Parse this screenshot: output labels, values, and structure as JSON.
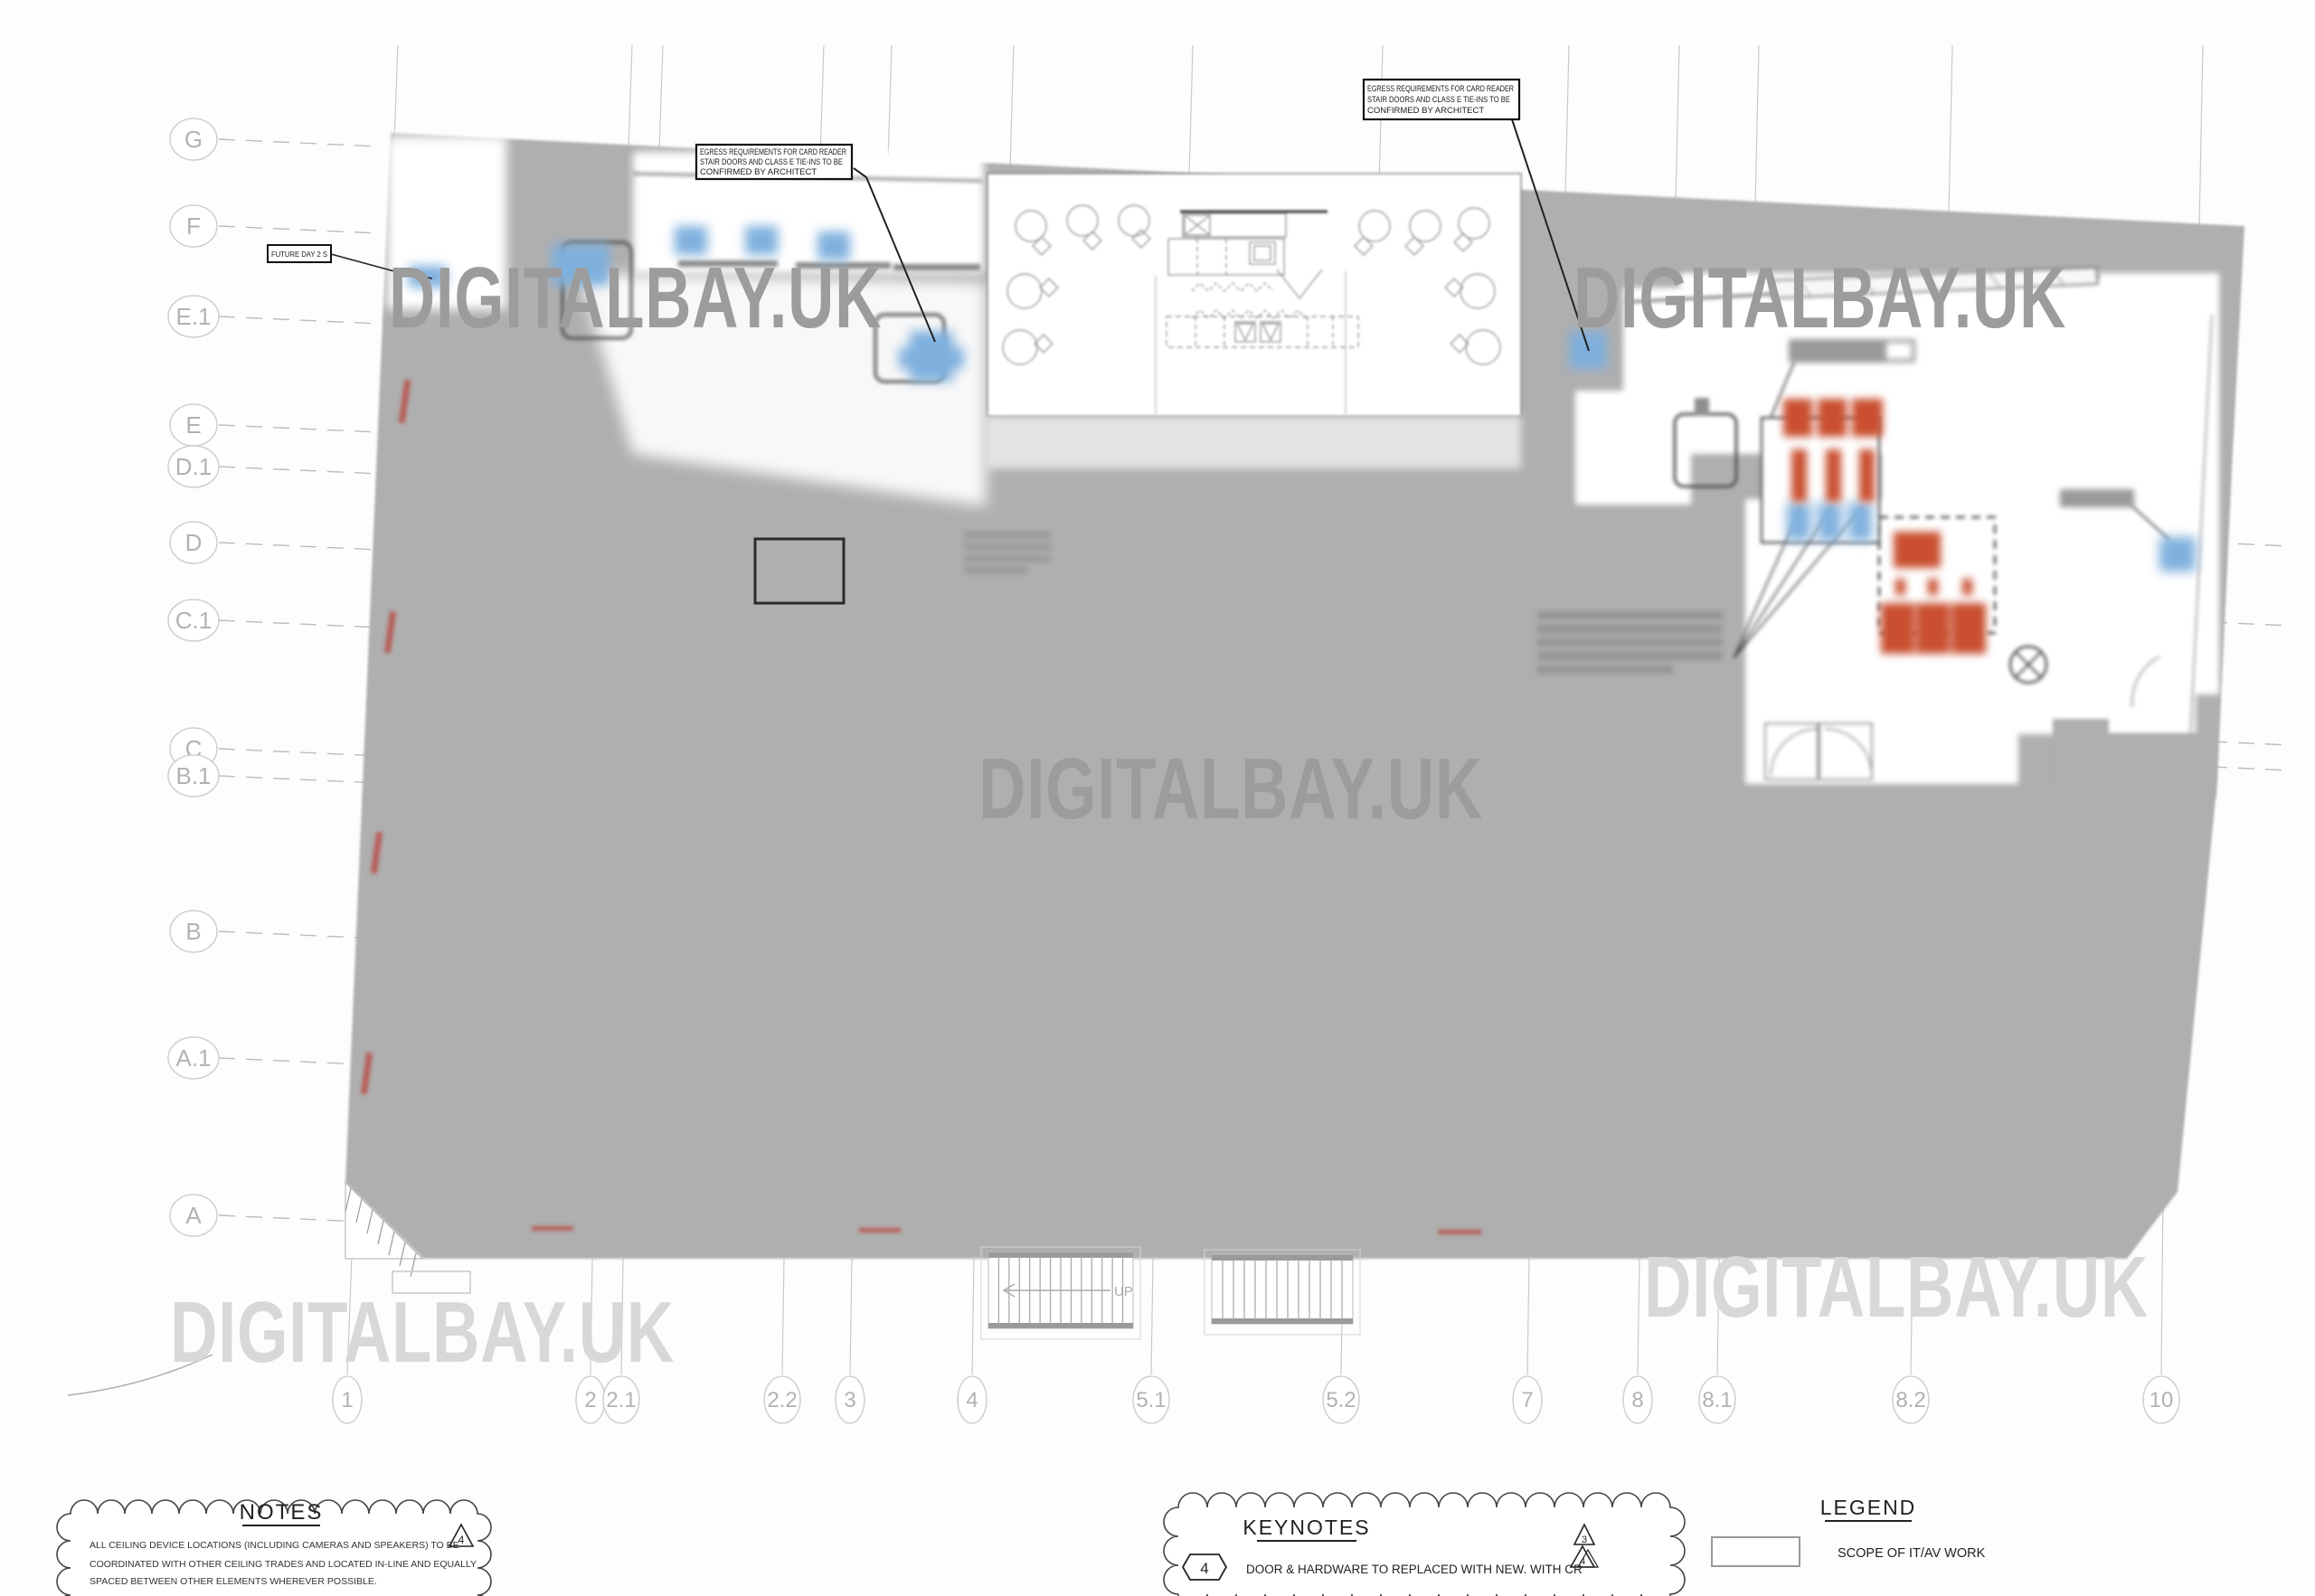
{
  "drawing": {
    "kind": "architectural floor plan - IT/AV scope",
    "watermark_text": "DIGITALBAY.UK"
  },
  "grid": {
    "row_labels": [
      "G",
      "F",
      "E.1",
      "E",
      "D.1",
      "D",
      "C.1",
      "C",
      "B.1",
      "B",
      "A.1",
      "A"
    ],
    "col_labels": [
      "1",
      "2",
      "2.1",
      "2.2",
      "3",
      "4",
      "5.1",
      "5.2",
      "7",
      "8",
      "8.1",
      "8.2",
      "10"
    ]
  },
  "callouts": {
    "egress": {
      "lines": [
        "EGRESS REQUIREMENTS FOR CARD READER",
        "STAIR DOORS AND CLASS E TIE-INS TO BE",
        "CONFIRMED BY ARCHITECT"
      ]
    },
    "future": {
      "label": "FUTURE DAY 2 S"
    }
  },
  "stairs": {
    "up_label": "UP"
  },
  "notes": {
    "title": "NOTES",
    "revision_marker": "4",
    "lines": [
      "ALL CEILING DEVICE LOCATIONS (INCLUDING CAMERAS AND SPEAKERS) TO BE",
      "COORDINATED WITH OTHER CEILING TRADES AND LOCATED IN-LINE AND EQUALLY",
      "SPACED BETWEEN OTHER ELEMENTS WHEREVER POSSIBLE."
    ]
  },
  "keynotes": {
    "title": "KEYNOTES",
    "items": [
      {
        "number": "4",
        "text": "DOOR & HARDWARE TO REPLACED WITH NEW. WITH CR"
      }
    ],
    "revision_markers": [
      "3",
      "4"
    ]
  },
  "legend": {
    "title": "LEGEND",
    "items": [
      {
        "label": "SCOPE OF IT/AV WORK"
      }
    ]
  },
  "colors": {
    "mask_gray": "#afafaf",
    "device_blue": "#7fb0dd",
    "equipment_red": "#c94f30",
    "watermark_on_gray": "#9c9c9c",
    "watermark_on_white": "#d8d8d8",
    "red_mark": "#b94a44"
  }
}
